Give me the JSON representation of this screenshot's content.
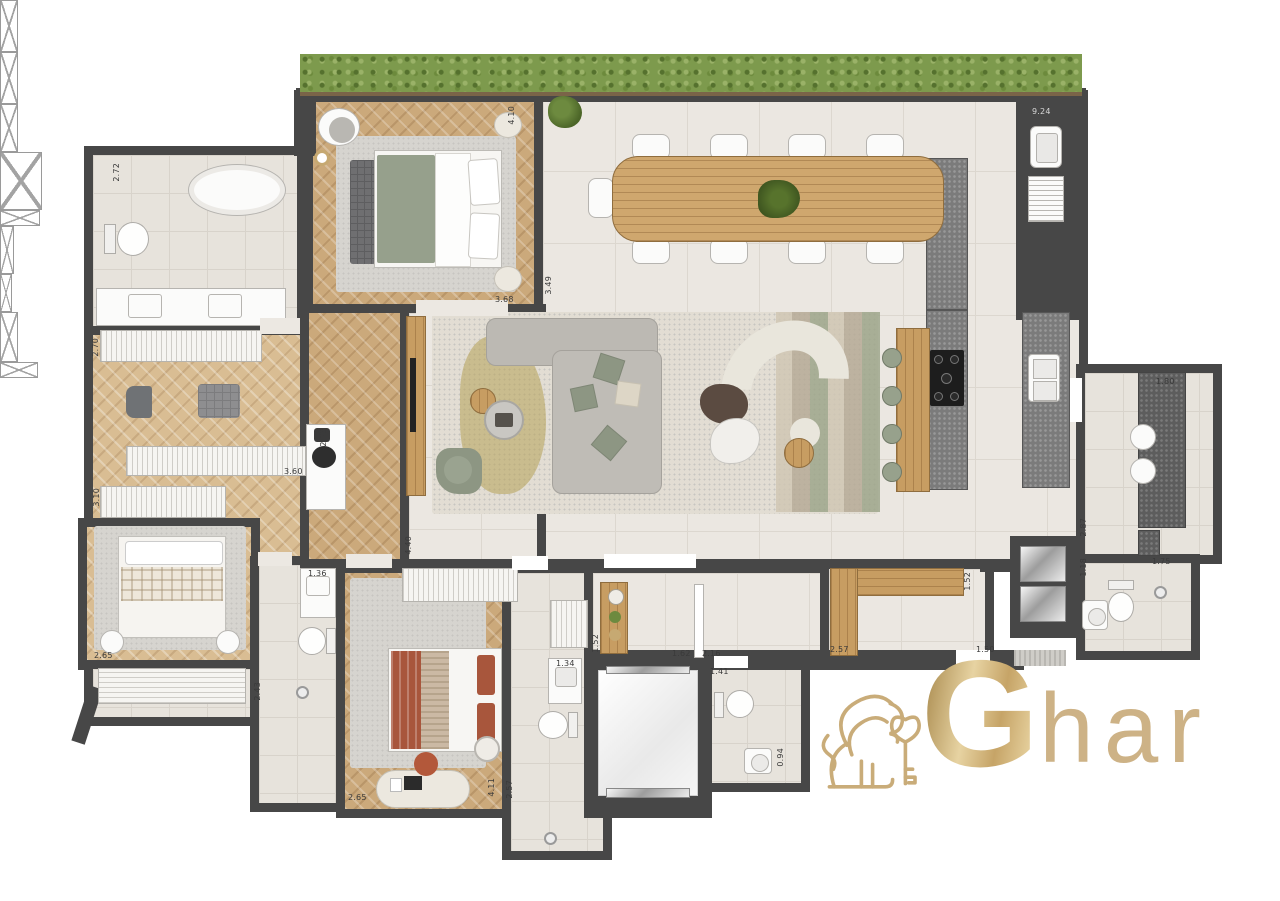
{
  "logo": {
    "icon": "lion-with-key-icon",
    "monogram": "G",
    "wordmark": "har"
  },
  "dims": [
    "2.72",
    "2.70",
    "3.10",
    "3.60",
    "2.38",
    "4.10",
    "3.68",
    "3.49",
    "9.24",
    "1.80",
    "2.87",
    "1.18",
    "1.75",
    "1.52",
    "2.57",
    "1.50",
    "1.52",
    "1.62",
    "2.16",
    "1.41",
    "0.94",
    "1.34",
    "2.57",
    "4.11",
    "2.65",
    "2.65",
    "1.36",
    "2.43",
    "4.40"
  ],
  "palette": {
    "wall": "#474747",
    "wood_floor": "#cba97b",
    "tile_floor": "#ebe7e1",
    "hedge_green": "#7d9a4d",
    "logo_gold": "#c6a972",
    "sofa_gray": "#bcb9b3",
    "sage_green": "#8d9683",
    "terracotta": "#a8563c",
    "granite": "#7b7b7b"
  }
}
